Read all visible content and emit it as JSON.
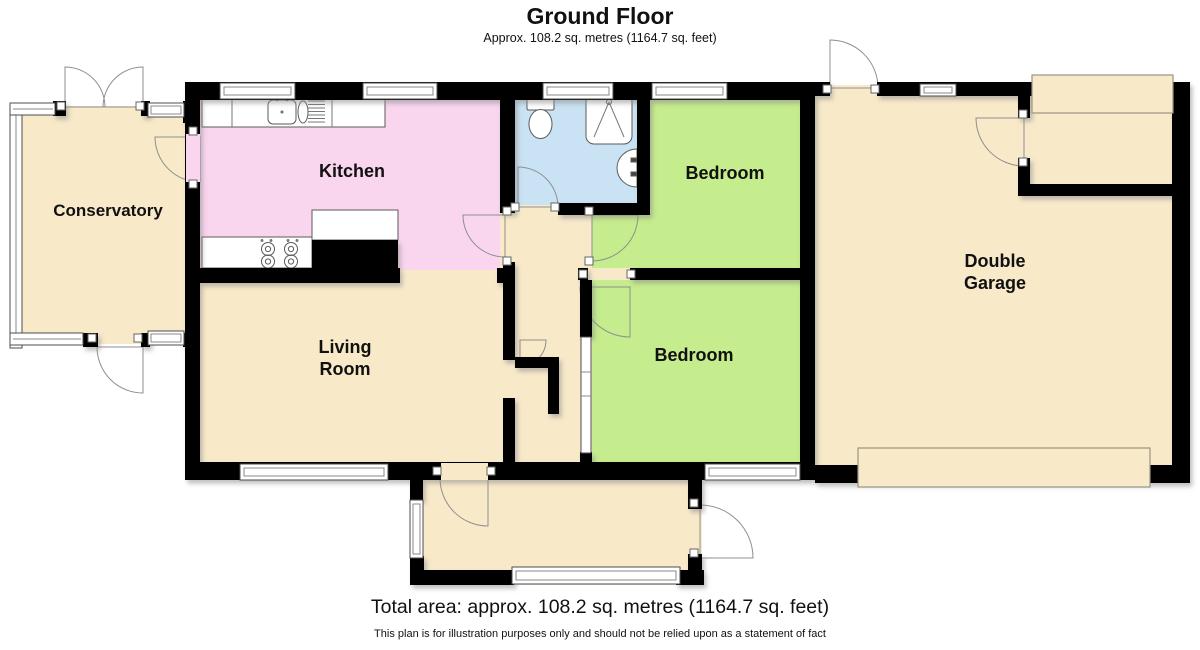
{
  "header": {
    "title": "Ground Floor",
    "subtitle": "Approx. 108.2 sq. metres (1164.7 sq. feet)"
  },
  "footer": {
    "total_area": "Total area: approx. 108.2 sq. metres (1164.7 sq. feet)",
    "disclaimer": "This plan is for illustration purposes only and should not be relied upon as a statement of fact"
  },
  "rooms": {
    "conservatory": {
      "label": "Conservatory",
      "color": "#f8e9c9"
    },
    "kitchen": {
      "label": "Kitchen",
      "color": "#f9d5ee"
    },
    "living_room": {
      "label_line1": "Living",
      "label_line2": "Room",
      "color": "#f8e9c9"
    },
    "bedroom_top": {
      "label": "Bedroom",
      "color": "#c5ec8d"
    },
    "bedroom_bottom": {
      "label": "Bedroom",
      "color": "#c5ec8d"
    },
    "bathroom": {
      "color": "#c9e2f4"
    },
    "hall": {
      "color": "#f8e9c9"
    },
    "porch": {
      "color": "#f8e9c9"
    },
    "garage": {
      "label_line1": "Double",
      "label_line2": "Garage",
      "color": "#f8e9c9"
    }
  },
  "palette": {
    "wall": "#000000",
    "window_frame": "#4d4d4d",
    "door_arc": "#8f8f8f",
    "fixture_outline": "#5a5a5a",
    "background": "#ffffff"
  },
  "icons": {
    "sink": "kitchen-sink-icon",
    "hob": "hob-icon",
    "toilet": "toilet-icon",
    "shower": "shower-icon",
    "basin": "basin-icon"
  }
}
